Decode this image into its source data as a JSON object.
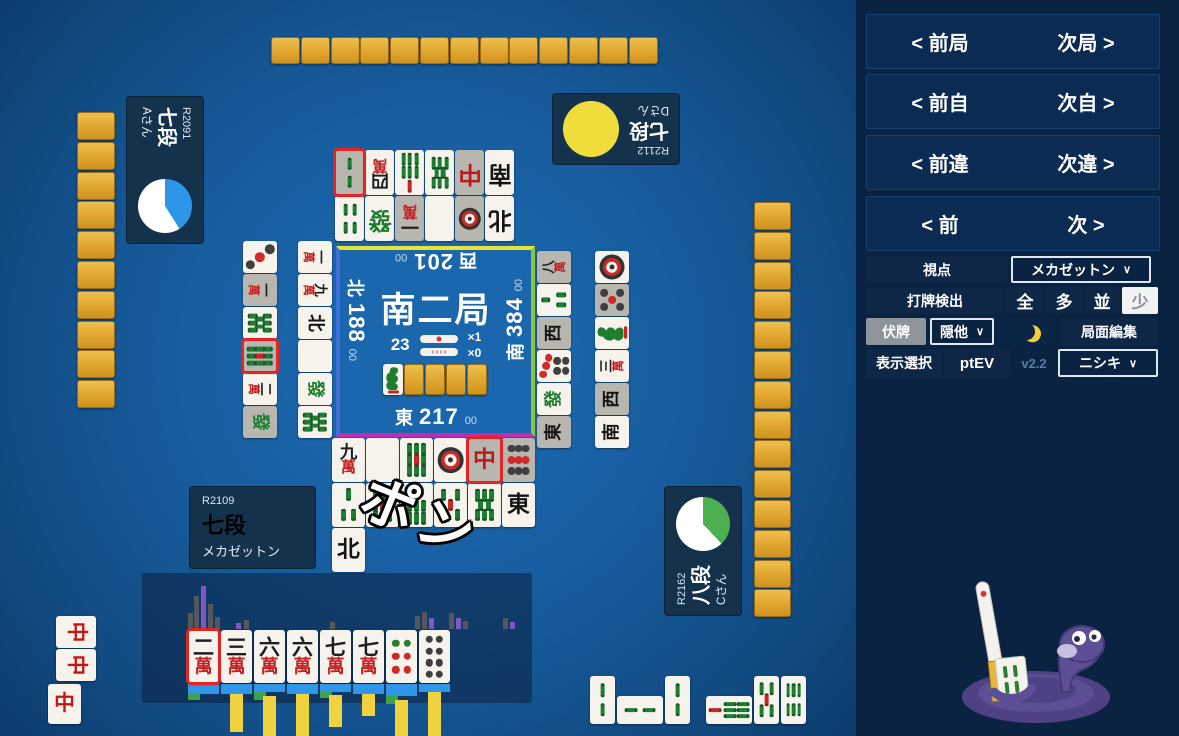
{
  "nav": {
    "rows": [
      {
        "prev": "< 前局",
        "next": "次局 >"
      },
      {
        "prev": "< 前自",
        "next": "次自 >"
      },
      {
        "prev": "< 前違",
        "next": "次違 >"
      },
      {
        "prev": "< 前",
        "next": "次 >"
      }
    ]
  },
  "controls": {
    "viewpoint": {
      "label": "視点",
      "value": "メカゼットン"
    },
    "detect": {
      "label": "打牌検出",
      "options": [
        "全",
        "多",
        "並",
        "少"
      ],
      "selected": "少"
    },
    "hidden": {
      "toggle": "伏牌",
      "select": "隠他",
      "edit": "局面編集"
    },
    "display": {
      "label": "表示選択",
      "ev": "ptEV",
      "version": "v2.2",
      "model": "ニシキ"
    }
  },
  "icons": {
    "chevron": "∨",
    "moon": "crescent-moon"
  },
  "players": {
    "left": {
      "rating": "R2091",
      "rank": "七段",
      "name": "Aさん",
      "pie": {
        "color": "#2e96e8",
        "pct": 41
      }
    },
    "top": {
      "rating": "R2112",
      "rank": "七段",
      "name": "Dさん",
      "pie": {
        "color": "#f0dd3b",
        "pct": 100
      }
    },
    "right": {
      "rating": "R2162",
      "rank": "八段",
      "name": "Cさん",
      "pie": {
        "color": "#4caf50",
        "pct": 38
      }
    },
    "self": {
      "rating": "R2109",
      "rank": "七段",
      "name": "メカゼットン"
    }
  },
  "center": {
    "round": "南二局",
    "tiles_left": "23",
    "stick1_count": "×1",
    "stick2_count": "×0",
    "scores": {
      "top": {
        "seat": "西",
        "val": "201",
        "cents": "00"
      },
      "left": {
        "seat": "北",
        "val": "188",
        "cents": "00"
      },
      "right": {
        "seat": "南",
        "val": "384",
        "cents": "00"
      },
      "bottom": {
        "seat": "東",
        "val": "217",
        "cents": "00"
      }
    },
    "border_colors": {
      "top": "#e9e432",
      "right": "#8cc63f",
      "bottom": "#c42bb5",
      "left": "#3e6fd8"
    },
    "dora_row": [
      "1s",
      "back",
      "back",
      "back",
      "back"
    ]
  },
  "call_text": "ポン",
  "walls": {
    "top": 13,
    "left": 10,
    "right": 14
  },
  "ponds": {
    "top": [
      [
        {
          "t": "2s",
          "gray": 1,
          "red": 1
        },
        {
          "t": "4m"
        },
        {
          "t": "7s"
        },
        {
          "t": "8s"
        },
        {
          "t": "C",
          "gray": 1
        },
        {
          "t": "S"
        }
      ],
      [
        {
          "t": "4s"
        },
        {
          "t": "F"
        },
        {
          "t": "1m",
          "gray": 1
        },
        {
          "t": "P"
        },
        {
          "t": "1p",
          "gray": 1
        },
        {
          "t": "N"
        }
      ]
    ],
    "left": [
      [
        {
          "t": "1m"
        },
        {
          "t": "9m"
        },
        {
          "t": "N"
        },
        {
          "t": "P"
        },
        {
          "t": "F"
        },
        {
          "t": "8s"
        }
      ],
      [
        {
          "t": "3p"
        },
        {
          "t": "1m",
          "gray": 1
        },
        {
          "t": "8s"
        },
        {
          "t": "9s",
          "gray": 1,
          "red": 1
        },
        {
          "t": "2m"
        },
        {
          "t": "F",
          "gray": 1
        }
      ]
    ],
    "right": [
      [
        {
          "t": "8m",
          "gray": 1
        },
        {
          "t": "3s"
        },
        {
          "t": "W",
          "gray": 1
        },
        {
          "t": "7p"
        },
        {
          "t": "F"
        },
        {
          "t": "E",
          "gray": 1
        }
      ],
      [
        {
          "t": "1p"
        },
        {
          "t": "5p",
          "gray": 1
        },
        {
          "t": "1s"
        },
        {
          "t": "3m"
        },
        {
          "t": "W",
          "gray": 1
        },
        {
          "t": "S"
        }
      ]
    ],
    "bottom": [
      [
        {
          "t": "9m"
        },
        {
          "t": "P"
        },
        {
          "t": "9s"
        },
        {
          "t": "1p"
        },
        {
          "t": "C",
          "gray": 1,
          "red": 1
        },
        {
          "t": "9p",
          "gray": 1
        }
      ],
      [
        {
          "t": "3s"
        },
        {
          "t": "9s"
        },
        {
          "t": "7s"
        },
        {
          "t": "5s"
        },
        {
          "t": "8s"
        },
        {
          "t": "E"
        }
      ],
      [
        {
          "t": "N"
        }
      ]
    ]
  },
  "melds": {
    "left_player": [
      "C",
      "C",
      "C"
    ],
    "self": [
      [
        {
          "t": "2s"
        },
        {
          "t": "2s",
          "rot": 1
        },
        {
          "t": "2s"
        }
      ],
      [
        {
          "t": "7s",
          "rot": 1
        },
        {
          "t": "5s"
        },
        {
          "t": "6s"
        }
      ]
    ]
  },
  "hand": {
    "tiles": [
      {
        "t": "2m",
        "red": 1,
        "below": {
          "b": 10,
          "g": 6,
          "y": 0
        }
      },
      {
        "t": "3m",
        "below": {
          "b": 10,
          "g": 0,
          "y": 38
        }
      },
      {
        "t": "6m",
        "below": {
          "b": 8,
          "g": 8,
          "y": 56
        }
      },
      {
        "t": "6m",
        "below": {
          "b": 10,
          "g": 0,
          "y": 50
        }
      },
      {
        "t": "7m",
        "below": {
          "b": 8,
          "g": 6,
          "y": 32
        }
      },
      {
        "t": "7m",
        "below": {
          "b": 10,
          "g": 0,
          "y": 22
        }
      },
      {
        "t": "6p",
        "below": {
          "b": 12,
          "g": 8,
          "y": 42
        }
      },
      {
        "t": "8p",
        "below": {
          "b": 8,
          "g": 0,
          "y": 56
        }
      }
    ],
    "bars_above": [
      {
        "x": 188,
        "h": 16,
        "c": "g"
      },
      {
        "x": 194,
        "h": 33,
        "c": "g"
      },
      {
        "x": 201,
        "h": 43,
        "c": "p"
      },
      {
        "x": 208,
        "h": 25,
        "c": "g"
      },
      {
        "x": 215,
        "h": 12,
        "c": "g"
      },
      {
        "x": 236,
        "h": 6,
        "c": "p"
      },
      {
        "x": 244,
        "h": 9,
        "c": "g"
      },
      {
        "x": 330,
        "h": 7,
        "c": "g"
      },
      {
        "x": 415,
        "h": 13,
        "c": "g"
      },
      {
        "x": 422,
        "h": 17,
        "c": "g"
      },
      {
        "x": 429,
        "h": 11,
        "c": "p"
      },
      {
        "x": 449,
        "h": 16,
        "c": "g"
      },
      {
        "x": 456,
        "h": 11,
        "c": "p"
      },
      {
        "x": 463,
        "h": 8,
        "c": "g"
      },
      {
        "x": 503,
        "h": 11,
        "c": "g"
      },
      {
        "x": 510,
        "h": 7,
        "c": "p"
      }
    ],
    "bar_colors": {
      "g": "#54585c",
      "p": "#7e57c2",
      "blue": "#2f96e8",
      "green": "#3fa14c",
      "yellow": "#f0d23e"
    }
  }
}
